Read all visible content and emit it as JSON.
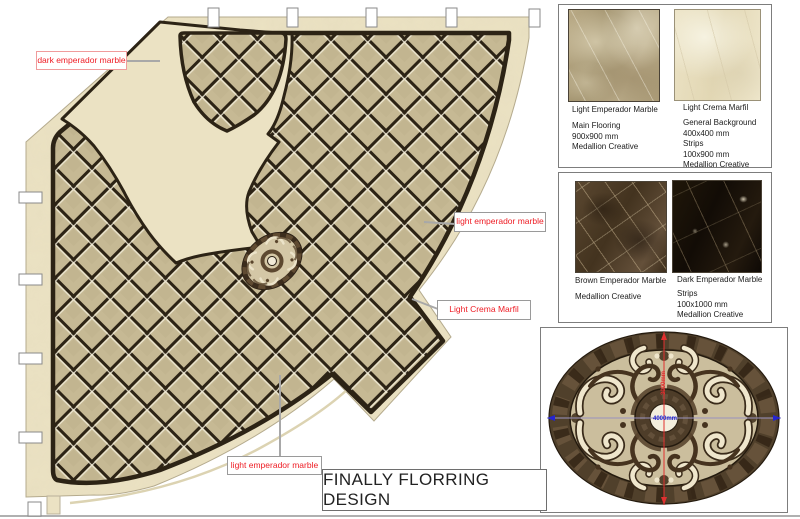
{
  "title_block": {
    "text": "FINALLY FLORRING DESIGN"
  },
  "plan": {
    "callouts": [
      {
        "text": "dark emperador marble"
      },
      {
        "text": "light emperador marble"
      },
      {
        "text": "Light Crema Marfil"
      },
      {
        "text": "light emperador marble"
      }
    ]
  },
  "panels": {
    "panel1": {
      "swatches": [
        {
          "name": "Light Emperador Marble",
          "notes": [
            "Main Flooring",
            "900x900 mm",
            "Medallion Creative"
          ]
        },
        {
          "name": "Light Crema Marfil",
          "notes": [
            "General Background",
            "400x400 mm",
            "Strips",
            "100x900 mm",
            "Medallion Creative"
          ]
        }
      ]
    },
    "panel2": {
      "swatches": [
        {
          "name": "Brown Emperador Marble",
          "notes": [
            "Medallion Creative"
          ]
        },
        {
          "name": "Dark Emperador Marble",
          "notes": [
            "Strips",
            "100x1000 mm",
            "Medallion Creative"
          ]
        }
      ]
    },
    "medallion": {
      "horizontal_dim": "4000mm",
      "vertical_dim": "3000mm"
    }
  },
  "colors": {
    "callout_red": "#ee1c24",
    "dim_blue": "#2323cf",
    "dim_red": "#e03030",
    "crema_band": "#ebe2c3",
    "field_tan": "#c6b994",
    "dark_line": "#2c2315",
    "ring_brown": "#50402b"
  }
}
